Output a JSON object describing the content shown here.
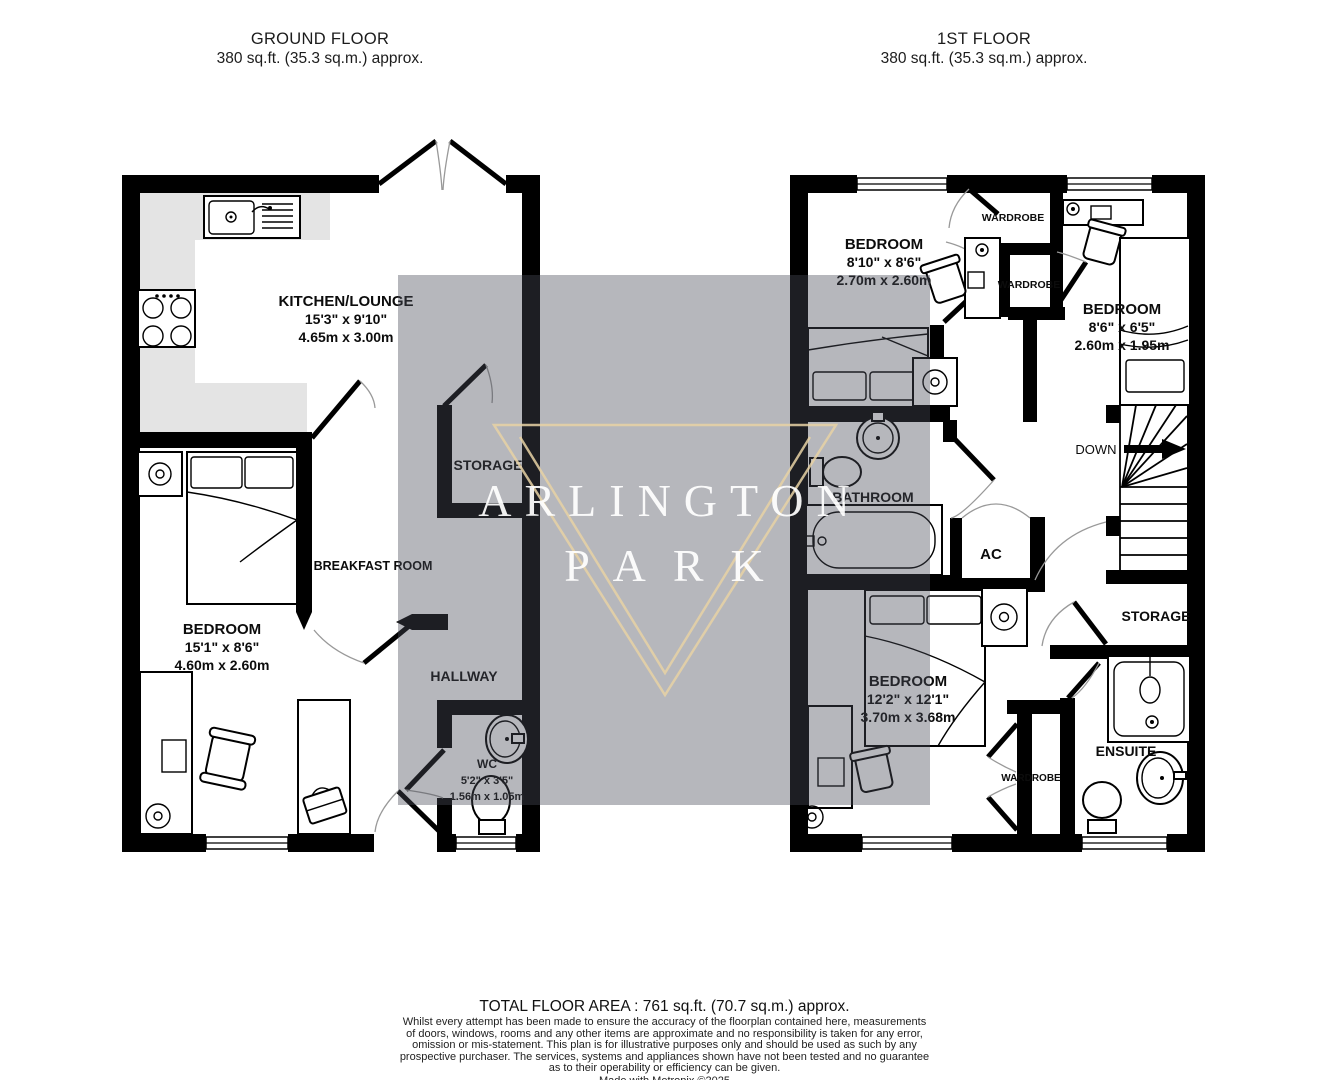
{
  "header": {
    "ground": {
      "title": "GROUND FLOOR",
      "area": "380 sq.ft. (35.3 sq.m.) approx."
    },
    "first": {
      "title": "1ST FLOOR",
      "area": "380 sq.ft. (35.3 sq.m.) approx."
    }
  },
  "ground_floor": {
    "kitchen_lounge": {
      "name": "KITCHEN/LOUNGE",
      "imperial": "15'3\"  x 9'10\"",
      "metric": "4.65m  x 3.00m"
    },
    "storage": {
      "name": "STORAGE"
    },
    "breakfast_room": {
      "name": "BREAKFAST ROOM"
    },
    "bedroom": {
      "name": "BEDROOM",
      "imperial": "15'1\"  x 8'6\"",
      "metric": "4.60m  x 2.60m"
    },
    "hallway": {
      "name": "HALLWAY"
    },
    "wc": {
      "name": "WC",
      "imperial": "5'2\"  x 3'5\"",
      "metric": "1.56m  x 1.05m"
    }
  },
  "first_floor": {
    "bedroom_1": {
      "name": "BEDROOM",
      "imperial": "8'10\"  x 8'6\"",
      "metric": "2.70m  x 2.60m"
    },
    "wardrobe_top": {
      "name": "WARDROBE"
    },
    "wardrobe_mid": {
      "name": "WARDROBE"
    },
    "bedroom_2": {
      "name": "BEDROOM",
      "imperial": "8'6\"  x 6'5\"",
      "metric": "2.60m  x 1.95m"
    },
    "bathroom": {
      "name": "BATHROOM"
    },
    "ac": {
      "name": "AC"
    },
    "down": {
      "name": "DOWN"
    },
    "storage": {
      "name": "STORAGE"
    },
    "bedroom_3": {
      "name": "BEDROOM",
      "imperial": "12'2\"  x 12'1\"",
      "metric": "3.70m  x 3.68m"
    },
    "wardrobe_bottom": {
      "name": "WARDROBE"
    },
    "ensuite": {
      "name": "ENSUITE"
    }
  },
  "watermark": {
    "line1": "ARLINGTON",
    "line2": "PARK"
  },
  "footer": {
    "total": "TOTAL FLOOR AREA : 761 sq.ft. (70.7 sq.m.) approx.",
    "disclaimer_lines": [
      "Whilst every attempt has been made to ensure the accuracy of the floorplan contained here, measurements",
      "of doors, windows, rooms and any other items are approximate and no responsibility is taken for any error,",
      "omission or mis-statement. This plan is for illustrative purposes only and should be used as such by any",
      "prospective purchaser. The services, systems and appliances shown have not been tested and no guarantee",
      "as to their operability or efficiency can be given."
    ],
    "credit": "Made with Metropix ©2025"
  },
  "colors": {
    "wall": "#000000",
    "counter": "#e4e4e4",
    "logo_gold": "#e8d2a4",
    "watermark_overlay": "rgba(72,76,88,0.40)",
    "watermark_text": "#ffffff"
  }
}
